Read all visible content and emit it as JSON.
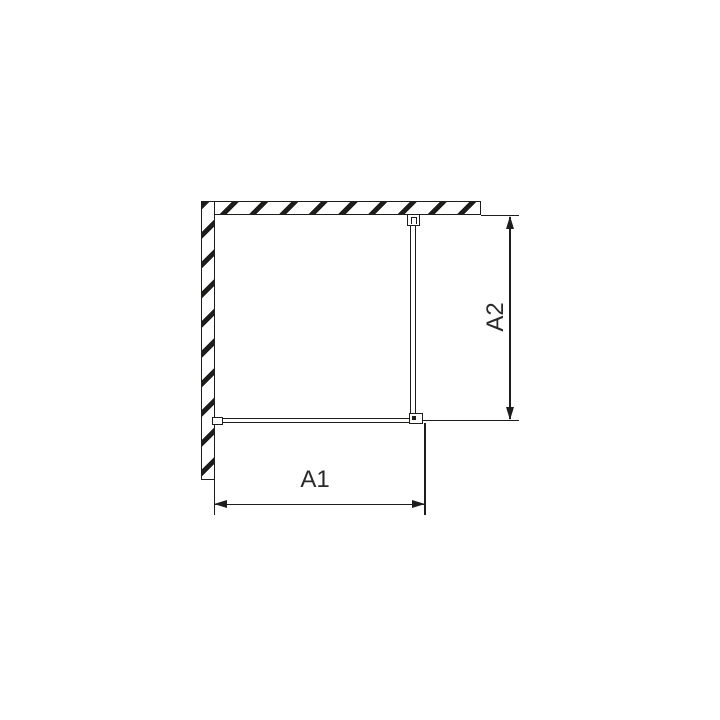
{
  "drawing": {
    "type": "technical-plan-view",
    "labels": {
      "a1": "A1",
      "a2": "A2"
    },
    "colors": {
      "background": "#ffffff",
      "line": "#1d1d1b",
      "text": "#2a2a28"
    }
  }
}
